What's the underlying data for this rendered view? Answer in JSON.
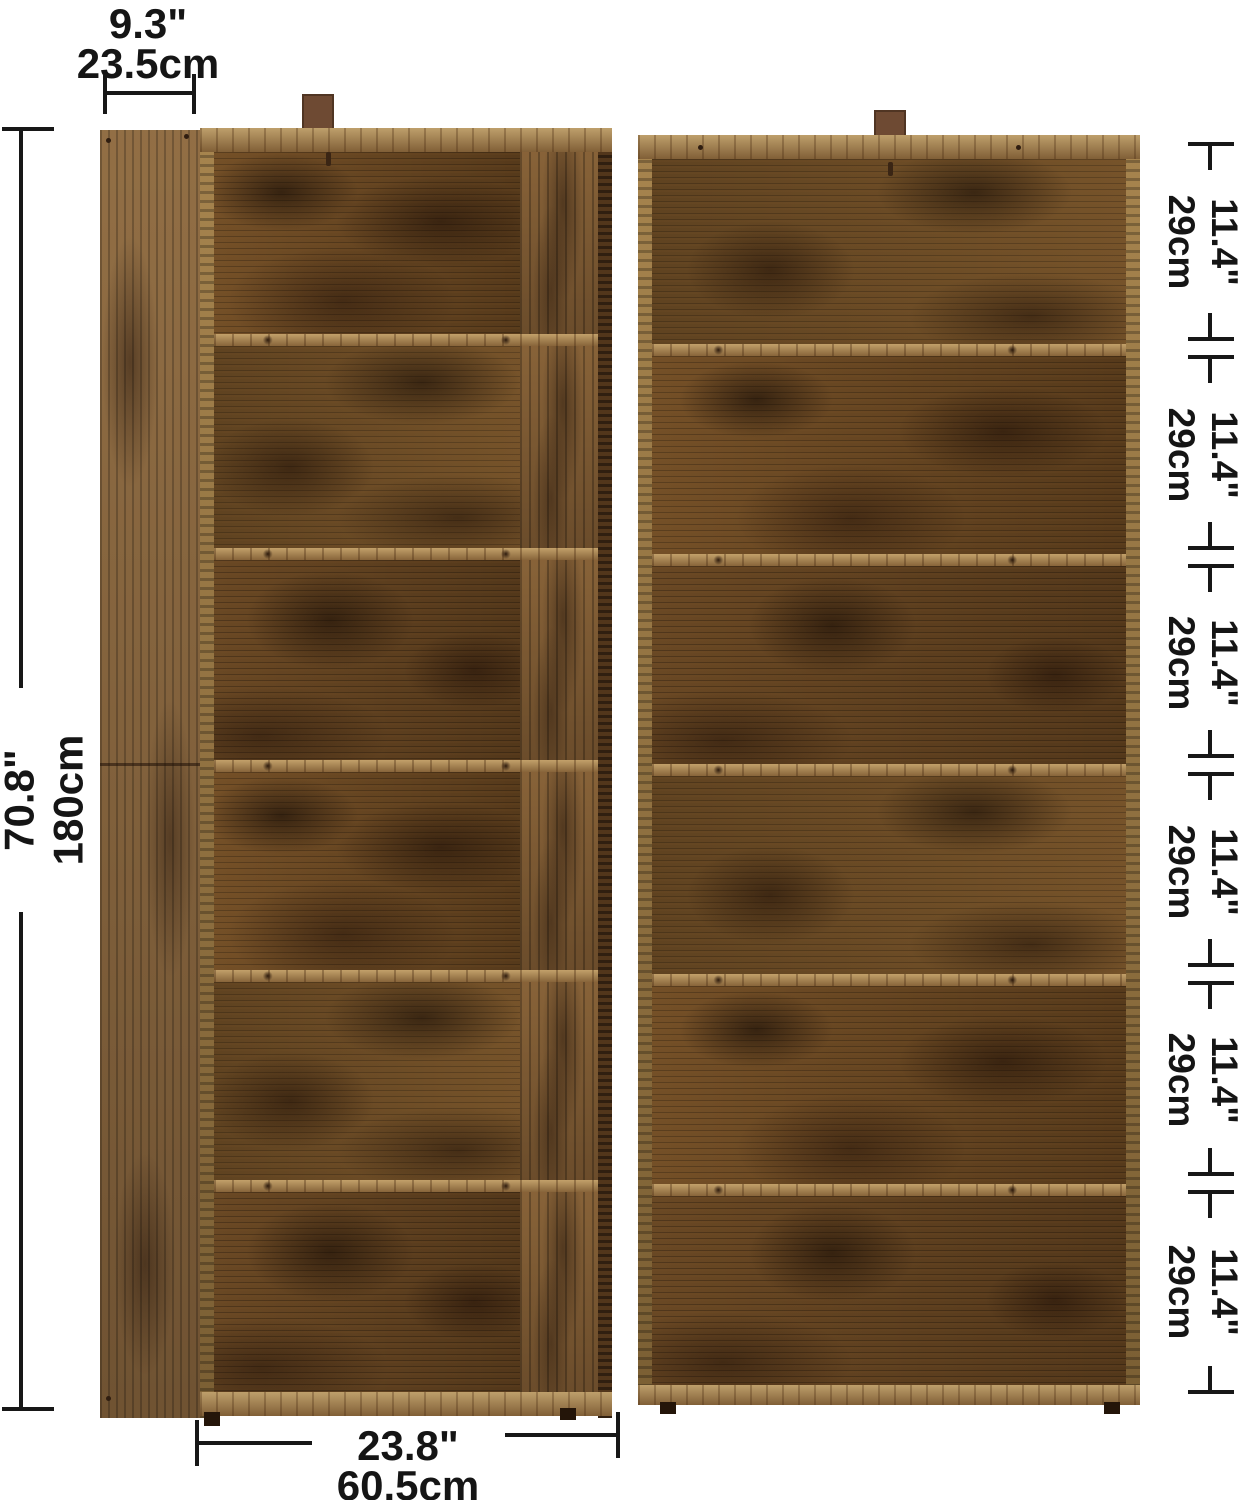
{
  "dims": {
    "depth": {
      "in": "9.3\"",
      "cm": "23.5cm"
    },
    "height": {
      "in": "70.8\"",
      "cm": "180cm"
    },
    "width": {
      "in": "23.8\"",
      "cm": "60.5cm"
    },
    "shelves": [
      {
        "in": "11.4\"",
        "cm": "29cm"
      },
      {
        "in": "11.4\"",
        "cm": "29cm"
      },
      {
        "in": "11.4\"",
        "cm": "29cm"
      },
      {
        "in": "11.4\"",
        "cm": "29cm"
      },
      {
        "in": "11.4\"",
        "cm": "29cm"
      },
      {
        "in": "11.4\"",
        "cm": "29cm"
      }
    ]
  },
  "colors": {
    "background": "#ffffff",
    "dim_line": "#171717",
    "wood_base": "#64431f",
    "wood_shelf": "#a8834f",
    "strap": "#6e4a33"
  }
}
